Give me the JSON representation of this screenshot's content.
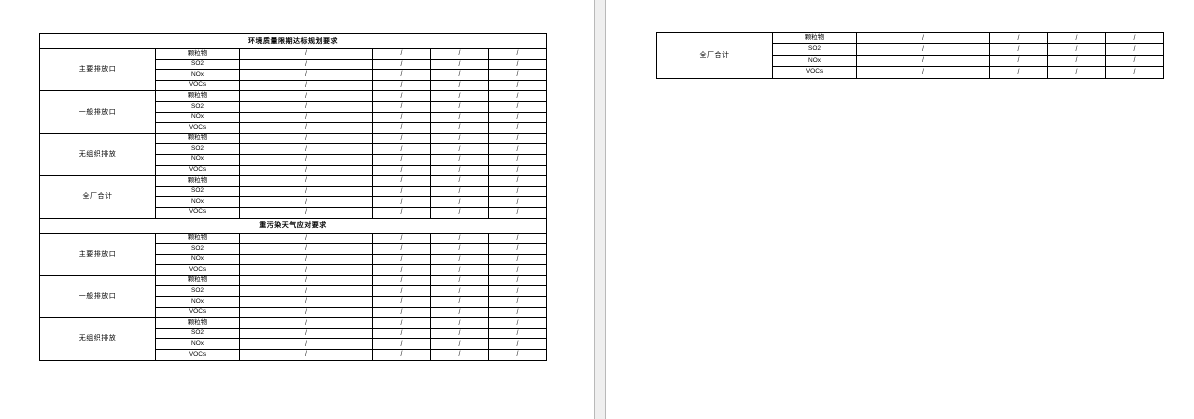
{
  "colors": {
    "page_background": "#ffffff",
    "table_border": "#000000",
    "page_gap_fill": "#efefef",
    "page_gap_edge": "#b9b9b9"
  },
  "placeholder_value": "/",
  "pages": [
    {
      "name": "page-1",
      "table": {
        "sections": [
          {
            "title": "环境质量限期达标规划要求",
            "groups": [
              {
                "label": "主要排放口",
                "rows": [
                  {
                    "pollutant": "颗粒物",
                    "values": [
                      "/",
                      "/",
                      "/",
                      "/"
                    ]
                  },
                  {
                    "pollutant": "SO2",
                    "values": [
                      "/",
                      "/",
                      "/",
                      "/"
                    ]
                  },
                  {
                    "pollutant": "NOx",
                    "values": [
                      "/",
                      "/",
                      "/",
                      "/"
                    ]
                  },
                  {
                    "pollutant": "VOCs",
                    "values": [
                      "/",
                      "/",
                      "/",
                      "/"
                    ]
                  }
                ]
              },
              {
                "label": "一般排放口",
                "rows": [
                  {
                    "pollutant": "颗粒物",
                    "values": [
                      "/",
                      "/",
                      "/",
                      "/"
                    ]
                  },
                  {
                    "pollutant": "SO2",
                    "values": [
                      "/",
                      "/",
                      "/",
                      "/"
                    ]
                  },
                  {
                    "pollutant": "NOx",
                    "values": [
                      "/",
                      "/",
                      "/",
                      "/"
                    ]
                  },
                  {
                    "pollutant": "VOCs",
                    "values": [
                      "/",
                      "/",
                      "/",
                      "/"
                    ]
                  }
                ]
              },
              {
                "label": "无组织排放",
                "rows": [
                  {
                    "pollutant": "颗粒物",
                    "values": [
                      "/",
                      "/",
                      "/",
                      "/"
                    ]
                  },
                  {
                    "pollutant": "SO2",
                    "values": [
                      "/",
                      "/",
                      "/",
                      "/"
                    ]
                  },
                  {
                    "pollutant": "NOx",
                    "values": [
                      "/",
                      "/",
                      "/",
                      "/"
                    ]
                  },
                  {
                    "pollutant": "VOCs",
                    "values": [
                      "/",
                      "/",
                      "/",
                      "/"
                    ]
                  }
                ]
              },
              {
                "label": "全厂合计",
                "rows": [
                  {
                    "pollutant": "颗粒物",
                    "values": [
                      "/",
                      "/",
                      "/",
                      "/"
                    ]
                  },
                  {
                    "pollutant": "SO2",
                    "values": [
                      "/",
                      "/",
                      "/",
                      "/"
                    ]
                  },
                  {
                    "pollutant": "NOx",
                    "values": [
                      "/",
                      "/",
                      "/",
                      "/"
                    ]
                  },
                  {
                    "pollutant": "VOCs",
                    "values": [
                      "/",
                      "/",
                      "/",
                      "/"
                    ]
                  }
                ]
              }
            ]
          },
          {
            "title": "重污染天气应对要求",
            "groups": [
              {
                "label": "主要排放口",
                "rows": [
                  {
                    "pollutant": "颗粒物",
                    "values": [
                      "/",
                      "/",
                      "/",
                      "/"
                    ]
                  },
                  {
                    "pollutant": "SO2",
                    "values": [
                      "/",
                      "/",
                      "/",
                      "/"
                    ]
                  },
                  {
                    "pollutant": "NOx",
                    "values": [
                      "/",
                      "/",
                      "/",
                      "/"
                    ]
                  },
                  {
                    "pollutant": "VOCs",
                    "values": [
                      "/",
                      "/",
                      "/",
                      "/"
                    ]
                  }
                ]
              },
              {
                "label": "一般排放口",
                "rows": [
                  {
                    "pollutant": "颗粒物",
                    "values": [
                      "/",
                      "/",
                      "/",
                      "/"
                    ]
                  },
                  {
                    "pollutant": "SO2",
                    "values": [
                      "/",
                      "/",
                      "/",
                      "/"
                    ]
                  },
                  {
                    "pollutant": "NOx",
                    "values": [
                      "/",
                      "/",
                      "/",
                      "/"
                    ]
                  },
                  {
                    "pollutant": "VOCs",
                    "values": [
                      "/",
                      "/",
                      "/",
                      "/"
                    ]
                  }
                ]
              },
              {
                "label": "无组织排放",
                "rows": [
                  {
                    "pollutant": "颗粒物",
                    "values": [
                      "/",
                      "/",
                      "/",
                      "/"
                    ]
                  },
                  {
                    "pollutant": "SO2",
                    "values": [
                      "/",
                      "/",
                      "/",
                      "/"
                    ]
                  },
                  {
                    "pollutant": "NOx",
                    "values": [
                      "/",
                      "/",
                      "/",
                      "/"
                    ]
                  },
                  {
                    "pollutant": "VOCs",
                    "values": [
                      "/",
                      "/",
                      "/",
                      "/"
                    ]
                  }
                ]
              }
            ]
          }
        ]
      }
    },
    {
      "name": "page-2",
      "table": {
        "sections": [
          {
            "title": null,
            "groups": [
              {
                "label": "全厂合计",
                "rows": [
                  {
                    "pollutant": "颗粒物",
                    "values": [
                      "/",
                      "/",
                      "/",
                      "/"
                    ]
                  },
                  {
                    "pollutant": "SO2",
                    "values": [
                      "/",
                      "/",
                      "/",
                      "/"
                    ]
                  },
                  {
                    "pollutant": "NOx",
                    "values": [
                      "/",
                      "/",
                      "/",
                      "/"
                    ]
                  },
                  {
                    "pollutant": "VOCs",
                    "values": [
                      "/",
                      "/",
                      "/",
                      "/"
                    ]
                  }
                ]
              }
            ]
          }
        ]
      }
    }
  ]
}
